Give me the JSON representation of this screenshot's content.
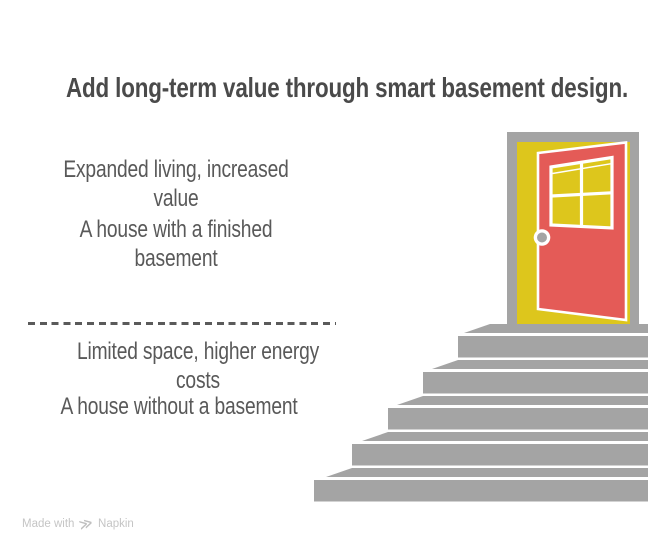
{
  "title": "Add long-term value through smart basement design.",
  "top_section": {
    "benefit_line1": "Expanded living, increased",
    "benefit_line2": "value",
    "label_line1": "A house with a finished",
    "label_line2": "basement"
  },
  "bottom_section": {
    "drawback_line1": "Limited space, higher energy",
    "drawback_line2": "costs",
    "label": "A house without a basement"
  },
  "footer": {
    "made_with": "Made with",
    "brand": "Napkin",
    "logo_glyph": "≫"
  },
  "colors": {
    "title_text": "#4a4a4a",
    "body_text": "#595959",
    "divider_gray": "#5a5a5a",
    "illustration_gray": "#a4a4a4",
    "door_red": "#e45b57",
    "door_yellow": "#ddc61c",
    "outline_white": "#ffffff",
    "watermark_text": "#c5c5c5"
  }
}
